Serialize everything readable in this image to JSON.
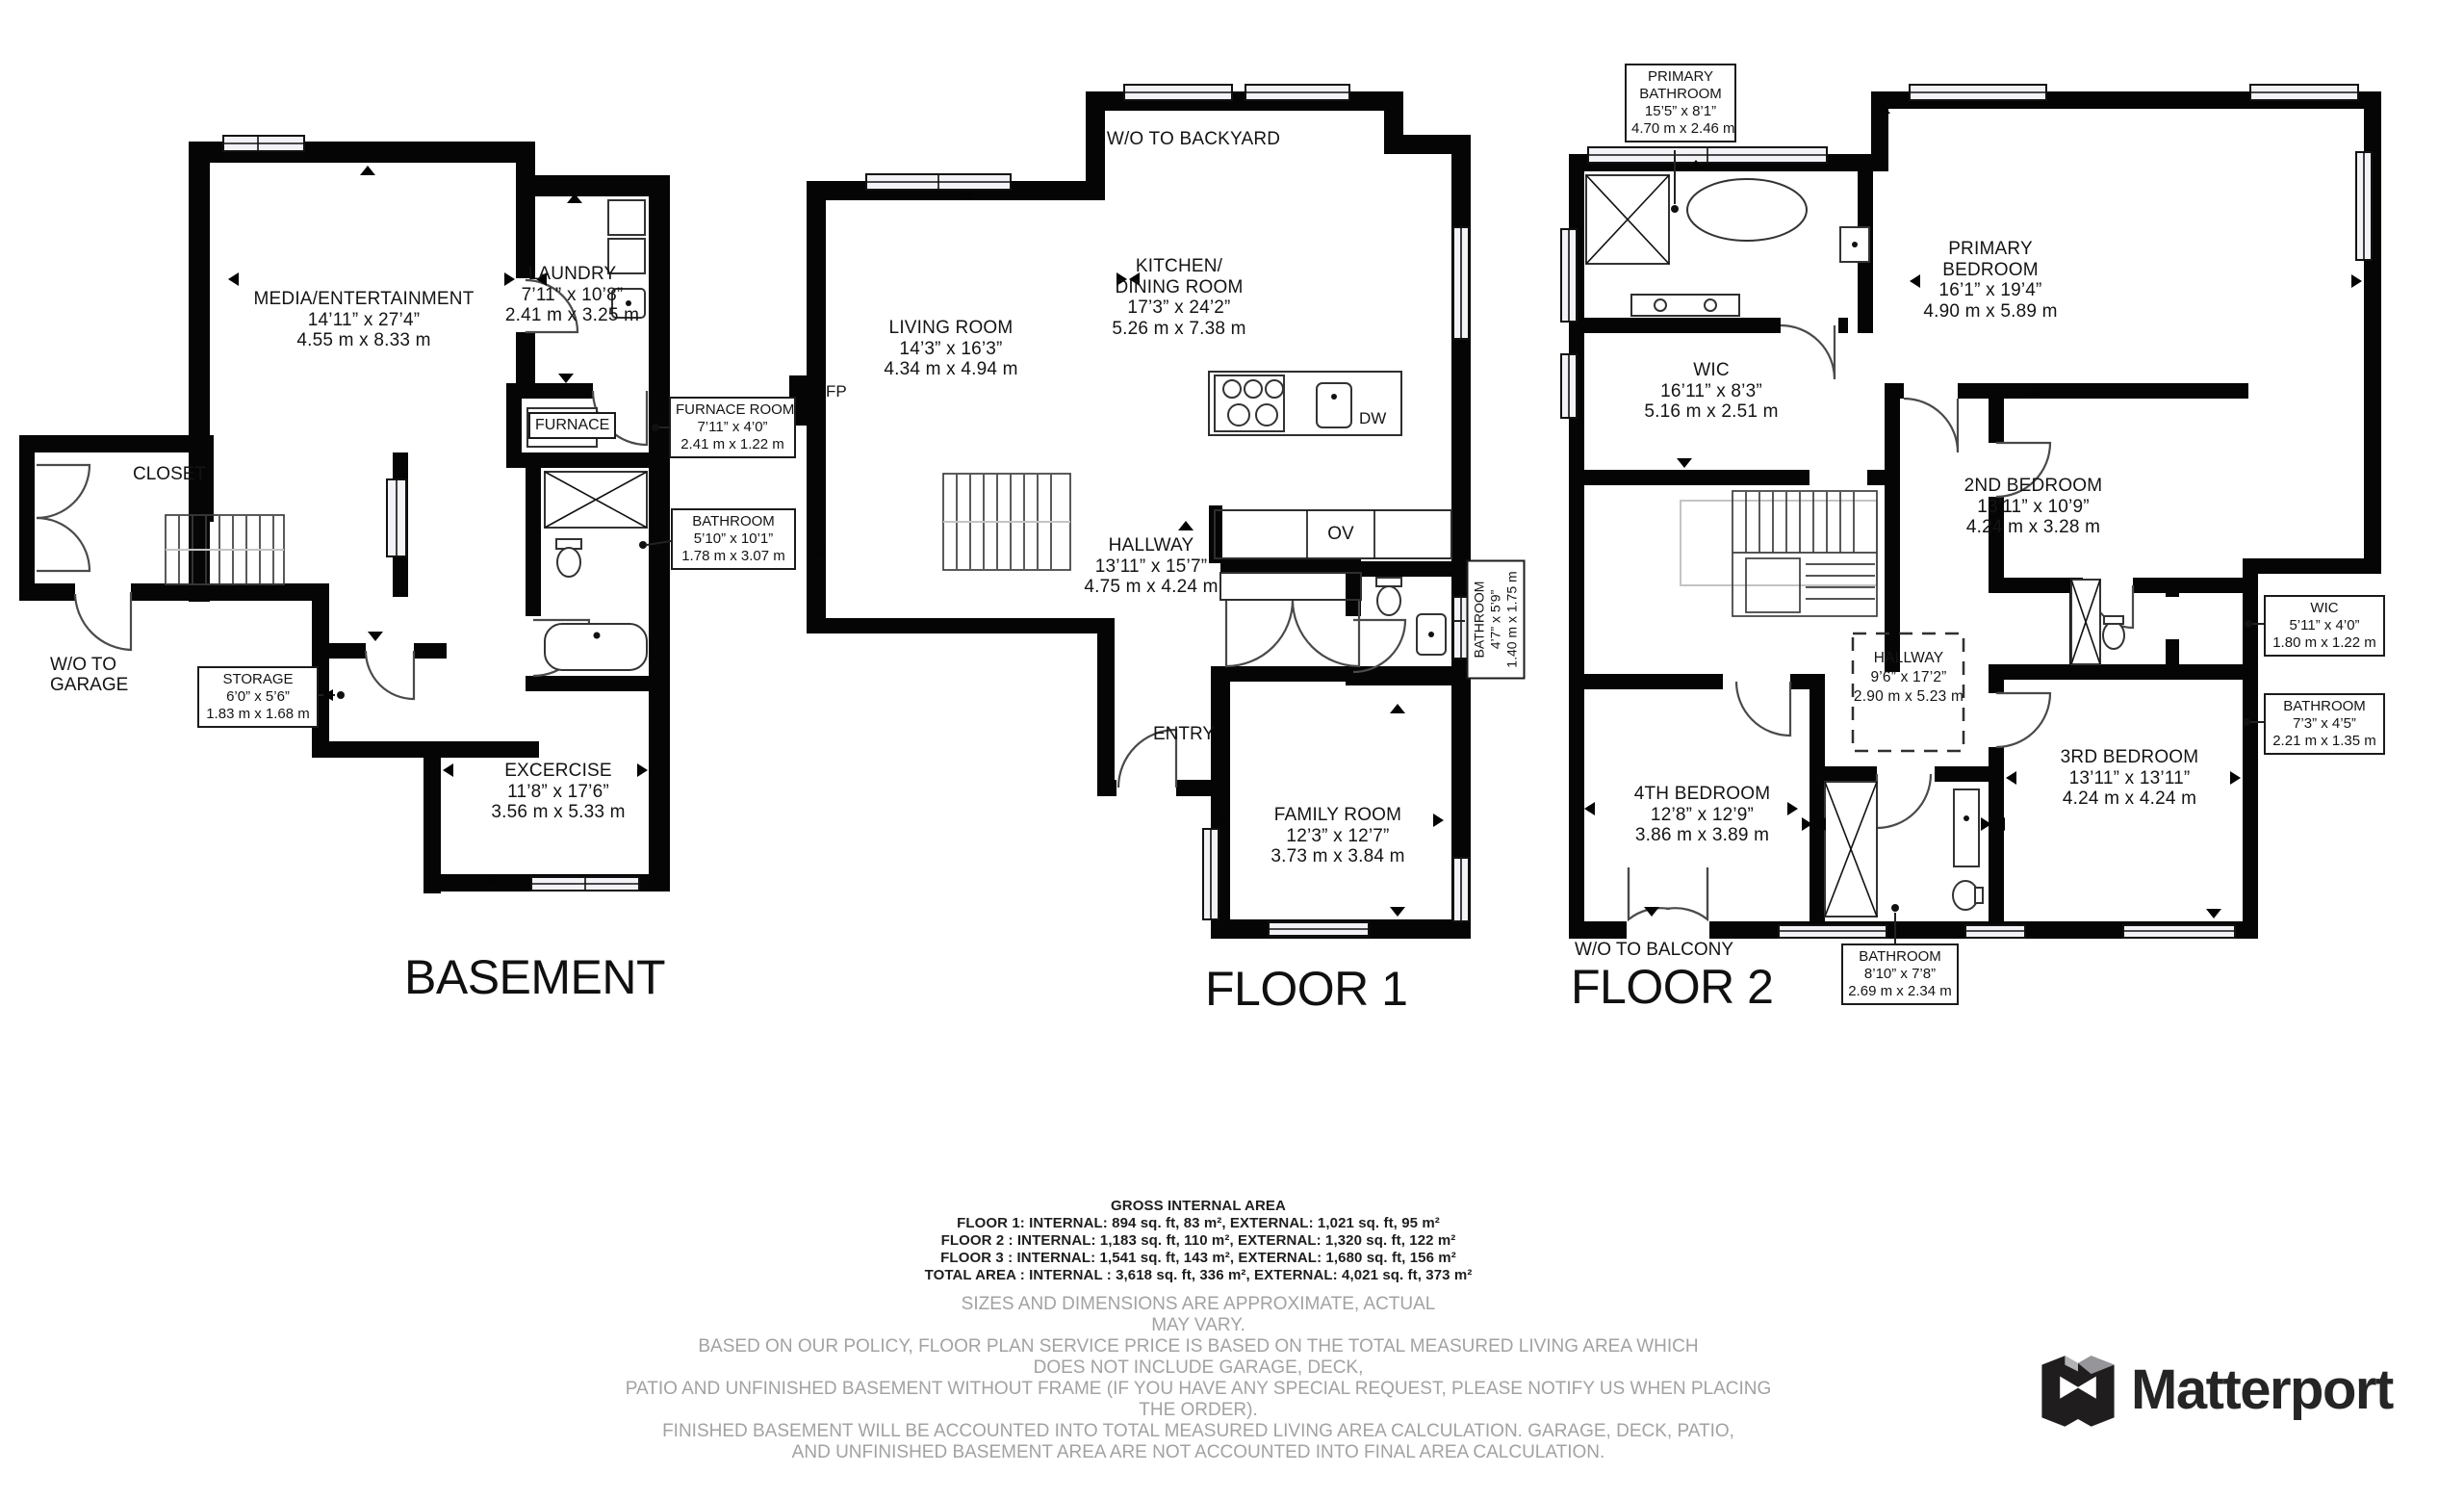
{
  "basement": {
    "title": "BASEMENT",
    "media": {
      "name": "MEDIA/ENTERTAINMENT",
      "imperial": "14’11” x 27’4”",
      "metric": "4.55 m x 8.33 m"
    },
    "laundry": {
      "name": "LAUNDRY",
      "im<br></br>perial": "",
      "imperial": "7’11” x 10’8”",
      "metric": "2.41 m x 3.25 m"
    },
    "furnace_unit": {
      "name": "FURNACE"
    },
    "furnace_room": {
      "name": "FURNACE ROOM",
      "imperial": "7’11” x 4’0”",
      "metric": "2.41 m x 1.22 m"
    },
    "bathroom": {
      "name": "BATHROOM",
      "imperial": "5’10” x 10’1”",
      "metric": "1.78 m x 3.07 m"
    },
    "closet": {
      "name": "CLOSET"
    },
    "wo_garage": {
      "line1": "W/O TO",
      "line2": "GARAGE"
    },
    "storage": {
      "name": "STORAGE",
      "imperial": "6’0” x 5’6”",
      "metric": "1.83 m x 1.68 m"
    },
    "exercise": {
      "name": "EXCERCISE",
      "imperial": "11’8” x 17’6”",
      "metric": "3.56 m x 5.33 m"
    }
  },
  "floor1": {
    "title": "FLOOR 1",
    "wo_backyard": "W/O TO BACKYARD",
    "living": {
      "name": "LIVING ROOM",
      "imperial": "14’3” x 16’3”",
      "metric": "4.34 m x 4.94 m"
    },
    "kitchen": {
      "line1": "KITCHEN/",
      "line2": "DINING ROOM",
      "imperial": "17’3” x 24’2”",
      "metric": "5.26 m x 7.38 m"
    },
    "fp": "FP",
    "ov": "OV",
    "dw": "DW",
    "hallway": {
      "name": "HALLWAY",
      "imperial": "13’11” x 15’7”",
      "metric": "4.75 m x 4.24 m"
    },
    "bathroom": {
      "name": "BATHROOM",
      "imperial": "4’7” x 5’9”",
      "metric": "1.40 m x 1.75 m"
    },
    "entry": "ENTRY",
    "family": {
      "name": "FAMILY ROOM",
      "imperial": "12’3” x 12’7”",
      "metric": "3.73 m x 3.84 m"
    }
  },
  "floor2": {
    "title": "FLOOR 2",
    "primary_bathroom": {
      "line1": "PRIMARY",
      "line2": "BATHROOM",
      "imperial": "15’5” x 8’1”",
      "metric": "4.70 m x 2.46 m"
    },
    "primary_bedroom": {
      "line1": "PRIMARY",
      "line2": "BEDROOM",
      "imperial": "16’1” x 19’4”",
      "metric": "4.90 m x 5.89 m"
    },
    "wic": {
      "name": "WIC",
      "imperial": "16’11” x 8’3”",
      "metric": "5.16 m x 2.51 m"
    },
    "bedroom2": {
      "name": "2ND BEDROOM",
      "imperial": "13’11” x 10’9”",
      "metric": "4.24 m x 3.28 m"
    },
    "wic2": {
      "name": "WIC",
      "imperial": "5’11” x 4’0”",
      "metric": "1.80 m x 1.22 m"
    },
    "bathroom2": {
      "name": "BATHROOM",
      "imperial": "7’3” x 4’5”",
      "metric": "2.21 m x 1.35 m"
    },
    "hallway": {
      "name": "HALLWAY",
      "imperial": "9’6” x 17’2”",
      "metric": "2.90 m x 5.23 m"
    },
    "bedroom4": {
      "name": "4TH BEDROOM",
      "imperial": "12’8” x 12’9”",
      "metric": "3.86 m x 3.89 m"
    },
    "bedroom3": {
      "name": "3RD BEDROOM",
      "imperial": "13’11” x 13’11”",
      "metric": "4.24 m x 4.24 m"
    },
    "bathroom3": {
      "name": "BATHROOM",
      "imperial": "8’10” x 7’8”",
      "metric": "2.69 m x 2.34 m"
    },
    "wo_balcony": "W/O TO BALCONY"
  },
  "footer": {
    "title": "GROSS INTERNAL AREA",
    "lines": [
      "FLOOR 1: INTERNAL: 894 sq. ft, 83 m², EXTERNAL: 1,021 sq. ft, 95 m²",
      "FLOOR 2 : INTERNAL: 1,183 sq. ft, 110 m², EXTERNAL: 1,320 sq. ft, 122 m²",
      "FLOOR 3 : INTERNAL: 1,541 sq. ft, 143 m², EXTERNAL: 1,680 sq. ft, 156 m²",
      "TOTAL AREA : INTERNAL : 3,618 sq. ft, 336 m², EXTERNAL: 4,021 sq. ft, 373 m²"
    ],
    "disclaimer": [
      "SIZES AND DIMENSIONS ARE APPROXIMATE, ACTUAL",
      "MAY VARY.",
      "BASED ON OUR POLICY, FLOOR PLAN SERVICE PRICE IS BASED ON THE TOTAL MEASURED LIVING AREA WHICH",
      "DOES NOT INCLUDE GARAGE, DECK,",
      "PATIO AND UNFINISHED BASEMENT WITHOUT FRAME (IF YOU HAVE ANY SPECIAL REQUEST, PLEASE NOTIFY US WHEN PLACING THE ORDER).",
      "FINISHED BASEMENT WILL BE ACCOUNTED INTO TOTAL MEASURED LIVING AREA CALCULATION. GARAGE, DECK, PATIO,",
      "AND UNFINISHED BASEMENT AREA ARE NOT ACCOUNTED INTO FINAL AREA CALCULATION."
    ]
  },
  "logo": {
    "text": "Matterport"
  }
}
